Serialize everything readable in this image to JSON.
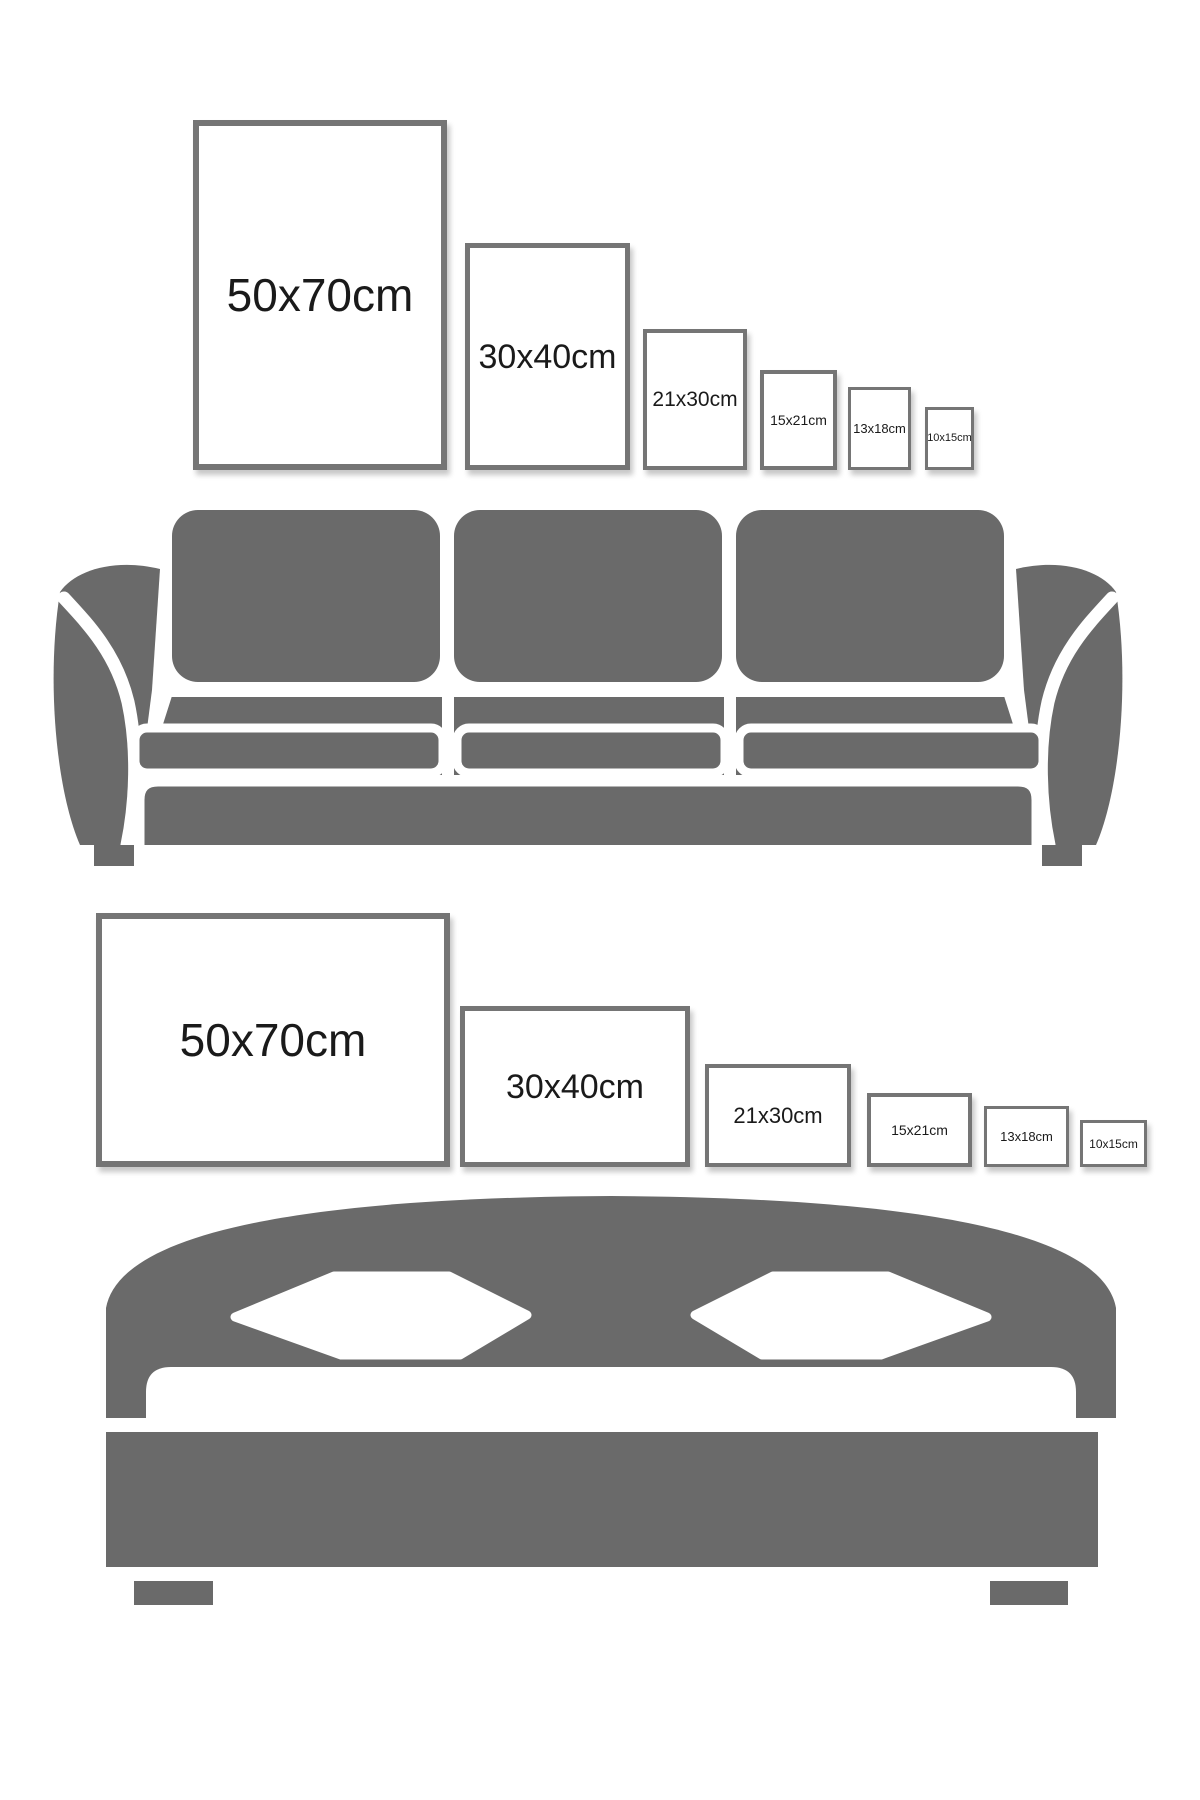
{
  "colors": {
    "background": "#ffffff",
    "furniture_gray": "#6a6a6a",
    "frame_border": "#757575",
    "label_text": "#1a1a1a"
  },
  "portrait_row": {
    "frames": [
      {
        "label": "50x70cm"
      },
      {
        "label": "30x40cm"
      },
      {
        "label": "21x30cm"
      },
      {
        "label": "15x21cm"
      },
      {
        "label": "13x18cm"
      },
      {
        "label": "10x15cm"
      }
    ]
  },
  "landscape_row": {
    "frames": [
      {
        "label": "50x70cm"
      },
      {
        "label": "30x40cm"
      },
      {
        "label": "21x30cm"
      },
      {
        "label": "15x21cm"
      },
      {
        "label": "13x18cm"
      },
      {
        "label": "10x15cm"
      }
    ]
  }
}
